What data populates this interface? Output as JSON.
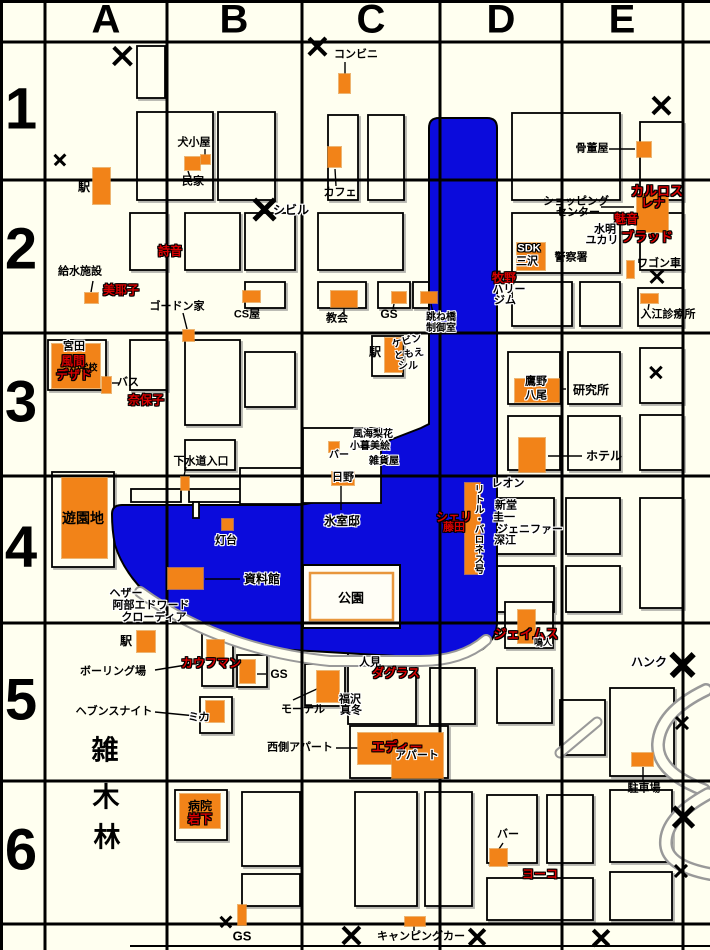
{
  "map_title": "town-grid-map",
  "colors": {
    "background": "#FFFFF0",
    "water": "#0B0BDC",
    "building_marker": "#F28318",
    "character_name_red": "#D70000",
    "grid_line": "#000000"
  },
  "grid": {
    "columns": [
      {
        "label": "A",
        "x": 106
      },
      {
        "label": "B",
        "x": 234
      },
      {
        "label": "C",
        "x": 371
      },
      {
        "label": "D",
        "x": 501
      },
      {
        "label": "E",
        "x": 622
      }
    ],
    "rows": [
      {
        "label": "1",
        "y": 109
      },
      {
        "label": "2",
        "y": 249
      },
      {
        "label": "3",
        "y": 402
      },
      {
        "label": "4",
        "y": 547
      },
      {
        "label": "5",
        "y": 700
      },
      {
        "label": "6",
        "y": 850
      }
    ]
  },
  "labels": [
    {
      "text": "コンビニ",
      "x": 356,
      "y": 55,
      "style": "k",
      "size": 11
    },
    {
      "text": "犬小屋",
      "x": 194,
      "y": 143,
      "style": "k",
      "size": 11
    },
    {
      "text": "民家",
      "x": 193,
      "y": 182,
      "style": "k",
      "size": 11
    },
    {
      "text": "駅",
      "x": 84,
      "y": 187,
      "style": "k",
      "size": 12
    },
    {
      "text": "カフェ",
      "x": 340,
      "y": 193,
      "style": "k",
      "size": 11
    },
    {
      "text": "骨董屋",
      "x": 592,
      "y": 149,
      "style": "k",
      "size": 11
    },
    {
      "text": "カルロス",
      "x": 657,
      "y": 191,
      "style": "r",
      "size": 13
    },
    {
      "text": "レナ",
      "x": 653,
      "y": 203,
      "style": "r",
      "size": 12
    },
    {
      "text": "ショッピング",
      "x": 576,
      "y": 202,
      "style": "k",
      "size": 11
    },
    {
      "text": "センター",
      "x": 578,
      "y": 213,
      "style": "k",
      "size": 11
    },
    {
      "text": "魅音",
      "x": 626,
      "y": 219,
      "style": "r",
      "size": 12
    },
    {
      "text": "水明",
      "x": 605,
      "y": 230,
      "style": "w",
      "size": 11
    },
    {
      "text": "ユカリ",
      "x": 602,
      "y": 241,
      "style": "w",
      "size": 11
    },
    {
      "text": "ブラッド",
      "x": 647,
      "y": 237,
      "style": "r",
      "size": 13
    },
    {
      "text": "シビル",
      "x": 291,
      "y": 210,
      "style": "w",
      "size": 12
    },
    {
      "text": "詩音",
      "x": 170,
      "y": 251,
      "style": "r",
      "size": 12
    },
    {
      "text": "SDK",
      "x": 529,
      "y": 249,
      "style": "wt",
      "size": 11
    },
    {
      "text": "三沢",
      "x": 527,
      "y": 262,
      "style": "w",
      "size": 11
    },
    {
      "text": "警察署",
      "x": 571,
      "y": 258,
      "style": "k",
      "size": 11
    },
    {
      "text": "牧野",
      "x": 504,
      "y": 278,
      "style": "r",
      "size": 12
    },
    {
      "text": "ハリー",
      "x": 509,
      "y": 290,
      "style": "w",
      "size": 11
    },
    {
      "text": "ジム",
      "x": 505,
      "y": 301,
      "style": "w",
      "size": 11
    },
    {
      "text": "ワゴン車",
      "x": 659,
      "y": 264,
      "style": "k",
      "size": 11
    },
    {
      "text": "入江診療所",
      "x": 668,
      "y": 315,
      "style": "k",
      "size": 11
    },
    {
      "text": "給水施設",
      "x": 80,
      "y": 272,
      "style": "k",
      "size": 11
    },
    {
      "text": "美耶子",
      "x": 121,
      "y": 290,
      "style": "r",
      "size": 12
    },
    {
      "text": "ゴードン家",
      "x": 177,
      "y": 307,
      "style": "k",
      "size": 11
    },
    {
      "text": "CS屋",
      "x": 247,
      "y": 315,
      "style": "k",
      "size": 11
    },
    {
      "text": "教会",
      "x": 337,
      "y": 319,
      "style": "k",
      "size": 11
    },
    {
      "text": "GS",
      "x": 389,
      "y": 314,
      "style": "k",
      "size": 12
    },
    {
      "text": "跳ね橋",
      "x": 441,
      "y": 318,
      "style": "w",
      "size": 10
    },
    {
      "text": "制御室",
      "x": 441,
      "y": 329,
      "style": "w",
      "size": 10
    },
    {
      "text": "小学校",
      "x": 84,
      "y": 368,
      "style": "k",
      "size": 9,
      "faint": true
    },
    {
      "text": "宮田",
      "x": 74,
      "y": 347,
      "style": "w",
      "size": 11
    },
    {
      "text": "風間",
      "x": 73,
      "y": 361,
      "style": "r",
      "size": 12
    },
    {
      "text": "デザド",
      "x": 74,
      "y": 375,
      "style": "r",
      "size": 12
    },
    {
      "text": "バス",
      "x": 128,
      "y": 383,
      "style": "k",
      "size": 11
    },
    {
      "text": "奈保子",
      "x": 146,
      "y": 400,
      "style": "r",
      "size": 12
    },
    {
      "text": "下水道入口",
      "x": 201,
      "y": 462,
      "style": "k",
      "size": 11
    },
    {
      "text": "駅",
      "x": 375,
      "y": 352,
      "style": "k",
      "size": 12
    },
    {
      "text": "ケビン",
      "x": 407,
      "y": 342,
      "style": "w",
      "size": 10,
      "rotate": -14
    },
    {
      "text": "ともえ",
      "x": 409,
      "y": 355,
      "style": "w",
      "size": 10,
      "rotate": -8
    },
    {
      "text": "シル",
      "x": 408,
      "y": 367,
      "style": "w",
      "size": 10
    },
    {
      "text": "鷹野",
      "x": 536,
      "y": 382,
      "style": "w",
      "size": 11
    },
    {
      "text": "八尾",
      "x": 536,
      "y": 396,
      "style": "w",
      "size": 11
    },
    {
      "text": "研究所",
      "x": 591,
      "y": 390,
      "style": "k",
      "size": 12
    },
    {
      "text": "ホテル",
      "x": 604,
      "y": 456,
      "style": "k",
      "size": 12
    },
    {
      "text": "風海梨花",
      "x": 373,
      "y": 435,
      "style": "w",
      "size": 10
    },
    {
      "text": "小暮美絵",
      "x": 370,
      "y": 447,
      "style": "w",
      "size": 10
    },
    {
      "text": "雑貨屋",
      "x": 384,
      "y": 462,
      "style": "w",
      "size": 10
    },
    {
      "text": "バー",
      "x": 339,
      "y": 456,
      "style": "w",
      "size": 10
    },
    {
      "text": "日野",
      "x": 343,
      "y": 478,
      "style": "w",
      "size": 11
    },
    {
      "text": "氷室邸",
      "x": 342,
      "y": 521,
      "style": "w",
      "size": 12
    },
    {
      "text": "レオン",
      "x": 508,
      "y": 484,
      "style": "w",
      "size": 11
    },
    {
      "text": "新堂",
      "x": 506,
      "y": 506,
      "style": "w",
      "size": 11
    },
    {
      "text": "圭一",
      "x": 504,
      "y": 518,
      "style": "w",
      "size": 11
    },
    {
      "text": "ジェニファー",
      "x": 530,
      "y": 530,
      "style": "w",
      "size": 11
    },
    {
      "text": "深江",
      "x": 505,
      "y": 541,
      "style": "w",
      "size": 11
    },
    {
      "text": "シェリ",
      "x": 454,
      "y": 517,
      "style": "r",
      "size": 12
    },
    {
      "text": "藤田",
      "x": 454,
      "y": 528,
      "style": "r",
      "size": 11
    },
    {
      "text": "リトル・バロネス号",
      "x": 477,
      "y": 529,
      "style": "w",
      "size": 10,
      "vertical": true
    },
    {
      "text": "遊園地",
      "x": 83,
      "y": 518,
      "style": "k",
      "size": 14
    },
    {
      "text": "灯台",
      "x": 226,
      "y": 541,
      "style": "w",
      "size": 11
    },
    {
      "text": "資料館",
      "x": 262,
      "y": 579,
      "style": "w",
      "size": 12
    },
    {
      "text": "公園",
      "x": 351,
      "y": 598,
      "style": "k",
      "size": 13
    },
    {
      "text": "ヘザー",
      "x": 126,
      "y": 594,
      "style": "w",
      "size": 11
    },
    {
      "text": "阿部エドワード",
      "x": 151,
      "y": 606,
      "style": "w",
      "size": 11
    },
    {
      "text": "クローディア",
      "x": 154,
      "y": 618,
      "style": "w",
      "size": 11
    },
    {
      "text": "駅",
      "x": 126,
      "y": 641,
      "style": "k",
      "size": 12
    },
    {
      "text": "ボーリング場",
      "x": 113,
      "y": 672,
      "style": "k",
      "size": 11
    },
    {
      "text": "カウフマン",
      "x": 211,
      "y": 663,
      "style": "r",
      "size": 12
    },
    {
      "text": "ヘブンスナイト",
      "x": 114,
      "y": 712,
      "style": "k",
      "size": 11
    },
    {
      "text": "ミカ",
      "x": 199,
      "y": 718,
      "style": "w",
      "size": 11
    },
    {
      "text": "雑",
      "x": 105,
      "y": 751,
      "style": "k",
      "size": 27
    },
    {
      "text": "木",
      "x": 106,
      "y": 798,
      "style": "k",
      "size": 27
    },
    {
      "text": "林",
      "x": 107,
      "y": 838,
      "style": "k",
      "size": 27
    },
    {
      "text": "GS",
      "x": 279,
      "y": 674,
      "style": "k",
      "size": 12
    },
    {
      "text": "モーテル",
      "x": 303,
      "y": 710,
      "style": "k",
      "size": 11
    },
    {
      "text": "人見",
      "x": 370,
      "y": 663,
      "style": "w",
      "size": 11
    },
    {
      "text": "ダグラス",
      "x": 396,
      "y": 673,
      "style": "r",
      "size": 12
    },
    {
      "text": "福沢",
      "x": 350,
      "y": 700,
      "style": "w",
      "size": 11
    },
    {
      "text": "真冬",
      "x": 351,
      "y": 711,
      "style": "w",
      "size": 11
    },
    {
      "text": "西側アパート",
      "x": 300,
      "y": 748,
      "style": "k",
      "size": 11
    },
    {
      "text": "エディー",
      "x": 397,
      "y": 747,
      "style": "r",
      "size": 13
    },
    {
      "text": "アパート",
      "x": 417,
      "y": 756,
      "style": "w",
      "size": 11
    },
    {
      "text": "ジェイムス",
      "x": 526,
      "y": 634,
      "style": "r",
      "size": 13
    },
    {
      "text": "鳴人",
      "x": 543,
      "y": 643,
      "style": "w",
      "size": 9
    },
    {
      "text": "ハンク",
      "x": 649,
      "y": 662,
      "style": "w",
      "size": 12
    },
    {
      "text": "駐車場",
      "x": 644,
      "y": 789,
      "style": "k",
      "size": 11
    },
    {
      "text": "病院",
      "x": 200,
      "y": 806,
      "style": "k",
      "size": 12
    },
    {
      "text": "岩下",
      "x": 200,
      "y": 819,
      "style": "r",
      "size": 12
    },
    {
      "text": "バー",
      "x": 508,
      "y": 835,
      "style": "k",
      "size": 11
    },
    {
      "text": "ヨーコ",
      "x": 540,
      "y": 874,
      "style": "r",
      "size": 12
    },
    {
      "text": "GS",
      "x": 242,
      "y": 936,
      "style": "k",
      "size": 13
    },
    {
      "text": "キャンピングカー",
      "x": 421,
      "y": 937,
      "style": "k",
      "size": 11
    }
  ],
  "buildings": [
    {
      "x": 93,
      "y": 168,
      "w": 17,
      "h": 36
    },
    {
      "x": 185,
      "y": 157,
      "w": 15,
      "h": 13
    },
    {
      "x": 201,
      "y": 155,
      "w": 9,
      "h": 9
    },
    {
      "x": 339,
      "y": 74,
      "w": 11,
      "h": 19
    },
    {
      "x": 328,
      "y": 147,
      "w": 13,
      "h": 20
    },
    {
      "x": 637,
      "y": 142,
      "w": 14,
      "h": 15
    },
    {
      "x": 637,
      "y": 194,
      "w": 31,
      "h": 38
    },
    {
      "x": 517,
      "y": 243,
      "w": 28,
      "h": 27
    },
    {
      "x": 627,
      "y": 261,
      "w": 7,
      "h": 17
    },
    {
      "x": 641,
      "y": 294,
      "w": 17,
      "h": 9
    },
    {
      "x": 85,
      "y": 293,
      "w": 13,
      "h": 10
    },
    {
      "x": 183,
      "y": 330,
      "w": 11,
      "h": 11
    },
    {
      "x": 243,
      "y": 291,
      "w": 17,
      "h": 11
    },
    {
      "x": 331,
      "y": 291,
      "w": 26,
      "h": 16
    },
    {
      "x": 392,
      "y": 292,
      "w": 14,
      "h": 11
    },
    {
      "x": 421,
      "y": 292,
      "w": 16,
      "h": 11
    },
    {
      "x": 52,
      "y": 344,
      "w": 48,
      "h": 44
    },
    {
      "x": 102,
      "y": 377,
      "w": 9,
      "h": 16
    },
    {
      "x": 181,
      "y": 477,
      "w": 8,
      "h": 13
    },
    {
      "x": 385,
      "y": 338,
      "w": 17,
      "h": 34
    },
    {
      "x": 515,
      "y": 379,
      "w": 44,
      "h": 23
    },
    {
      "x": 519,
      "y": 438,
      "w": 26,
      "h": 34
    },
    {
      "x": 329,
      "y": 442,
      "w": 10,
      "h": 10
    },
    {
      "x": 332,
      "y": 472,
      "w": 22,
      "h": 13
    },
    {
      "x": 62,
      "y": 478,
      "w": 45,
      "h": 80
    },
    {
      "x": 222,
      "y": 519,
      "w": 11,
      "h": 11
    },
    {
      "x": 168,
      "y": 568,
      "w": 35,
      "h": 21
    },
    {
      "x": 465,
      "y": 483,
      "w": 15,
      "h": 91
    },
    {
      "x": 518,
      "y": 610,
      "w": 17,
      "h": 33
    },
    {
      "x": 137,
      "y": 631,
      "w": 18,
      "h": 21
    },
    {
      "x": 207,
      "y": 640,
      "w": 17,
      "h": 20
    },
    {
      "x": 206,
      "y": 701,
      "w": 18,
      "h": 21
    },
    {
      "x": 240,
      "y": 660,
      "w": 15,
      "h": 23
    },
    {
      "x": 317,
      "y": 671,
      "w": 22,
      "h": 31
    },
    {
      "x": 358,
      "y": 733,
      "w": 34,
      "h": 31
    },
    {
      "x": 392,
      "y": 733,
      "w": 51,
      "h": 45
    },
    {
      "x": 632,
      "y": 753,
      "w": 21,
      "h": 13
    },
    {
      "x": 180,
      "y": 794,
      "w": 40,
      "h": 34
    },
    {
      "x": 490,
      "y": 849,
      "w": 17,
      "h": 17
    },
    {
      "x": 405,
      "y": 917,
      "w": 20,
      "h": 9
    },
    {
      "x": 238,
      "y": 905,
      "w": 8,
      "h": 20
    }
  ],
  "x_marks": [
    {
      "x": 122,
      "y": 56,
      "s": 22
    },
    {
      "x": 60,
      "y": 160,
      "s": 13
    },
    {
      "x": 317,
      "y": 47,
      "s": 21
    },
    {
      "x": 661,
      "y": 106,
      "s": 21
    },
    {
      "x": 265,
      "y": 210,
      "s": 26
    },
    {
      "x": 657,
      "y": 277,
      "s": 16
    },
    {
      "x": 656,
      "y": 372,
      "s": 14
    },
    {
      "x": 683,
      "y": 665,
      "s": 28
    },
    {
      "x": 682,
      "y": 723,
      "s": 15
    },
    {
      "x": 683,
      "y": 817,
      "s": 25
    },
    {
      "x": 681,
      "y": 871,
      "s": 15
    },
    {
      "x": 226,
      "y": 922,
      "s": 13
    },
    {
      "x": 351,
      "y": 936,
      "s": 21
    },
    {
      "x": 477,
      "y": 937,
      "s": 20
    },
    {
      "x": 601,
      "y": 938,
      "s": 20
    }
  ]
}
